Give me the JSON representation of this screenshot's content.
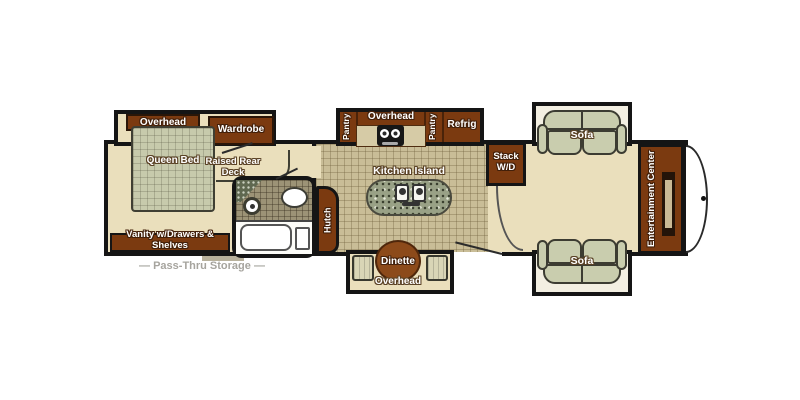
{
  "colors": {
    "wall": "#151515",
    "cabinet_wood": "#7b3a10",
    "carpet": "#eadfbc",
    "kitchen_tile": "#c9bd97",
    "bathroom_tile": "#9c9376",
    "upholstery": "#c9cdae",
    "dinette_table": "#8c4a1a",
    "island_granite": "#99a186",
    "storage_label_gray": "#a6a49e"
  },
  "plan": {
    "bedroom": {
      "overhead": "Overhead",
      "wardrobe": "Wardrobe",
      "queen_bed": "Queen Bed",
      "raised_rear_deck": "Raised Rear Deck",
      "vanity": "Vanity w/Drawers & Shelves"
    },
    "kitchen": {
      "pantry_left": "Pantry",
      "overhead": "Overhead",
      "pantry_right": "Pantry",
      "refrigerator": "Refrig",
      "island": "Kitchen Island",
      "hutch": "Hutch",
      "stack_wd": "Stack W/D"
    },
    "dinette": {
      "table": "Dinette",
      "overhead": "Overhead"
    },
    "living": {
      "sofa_rear": "Sofa",
      "sofa_front": "Sofa",
      "entertainment_center": "Entertainment Center"
    },
    "exterior": {
      "pass_thru_storage": "— Pass-Thru Storage —"
    }
  }
}
